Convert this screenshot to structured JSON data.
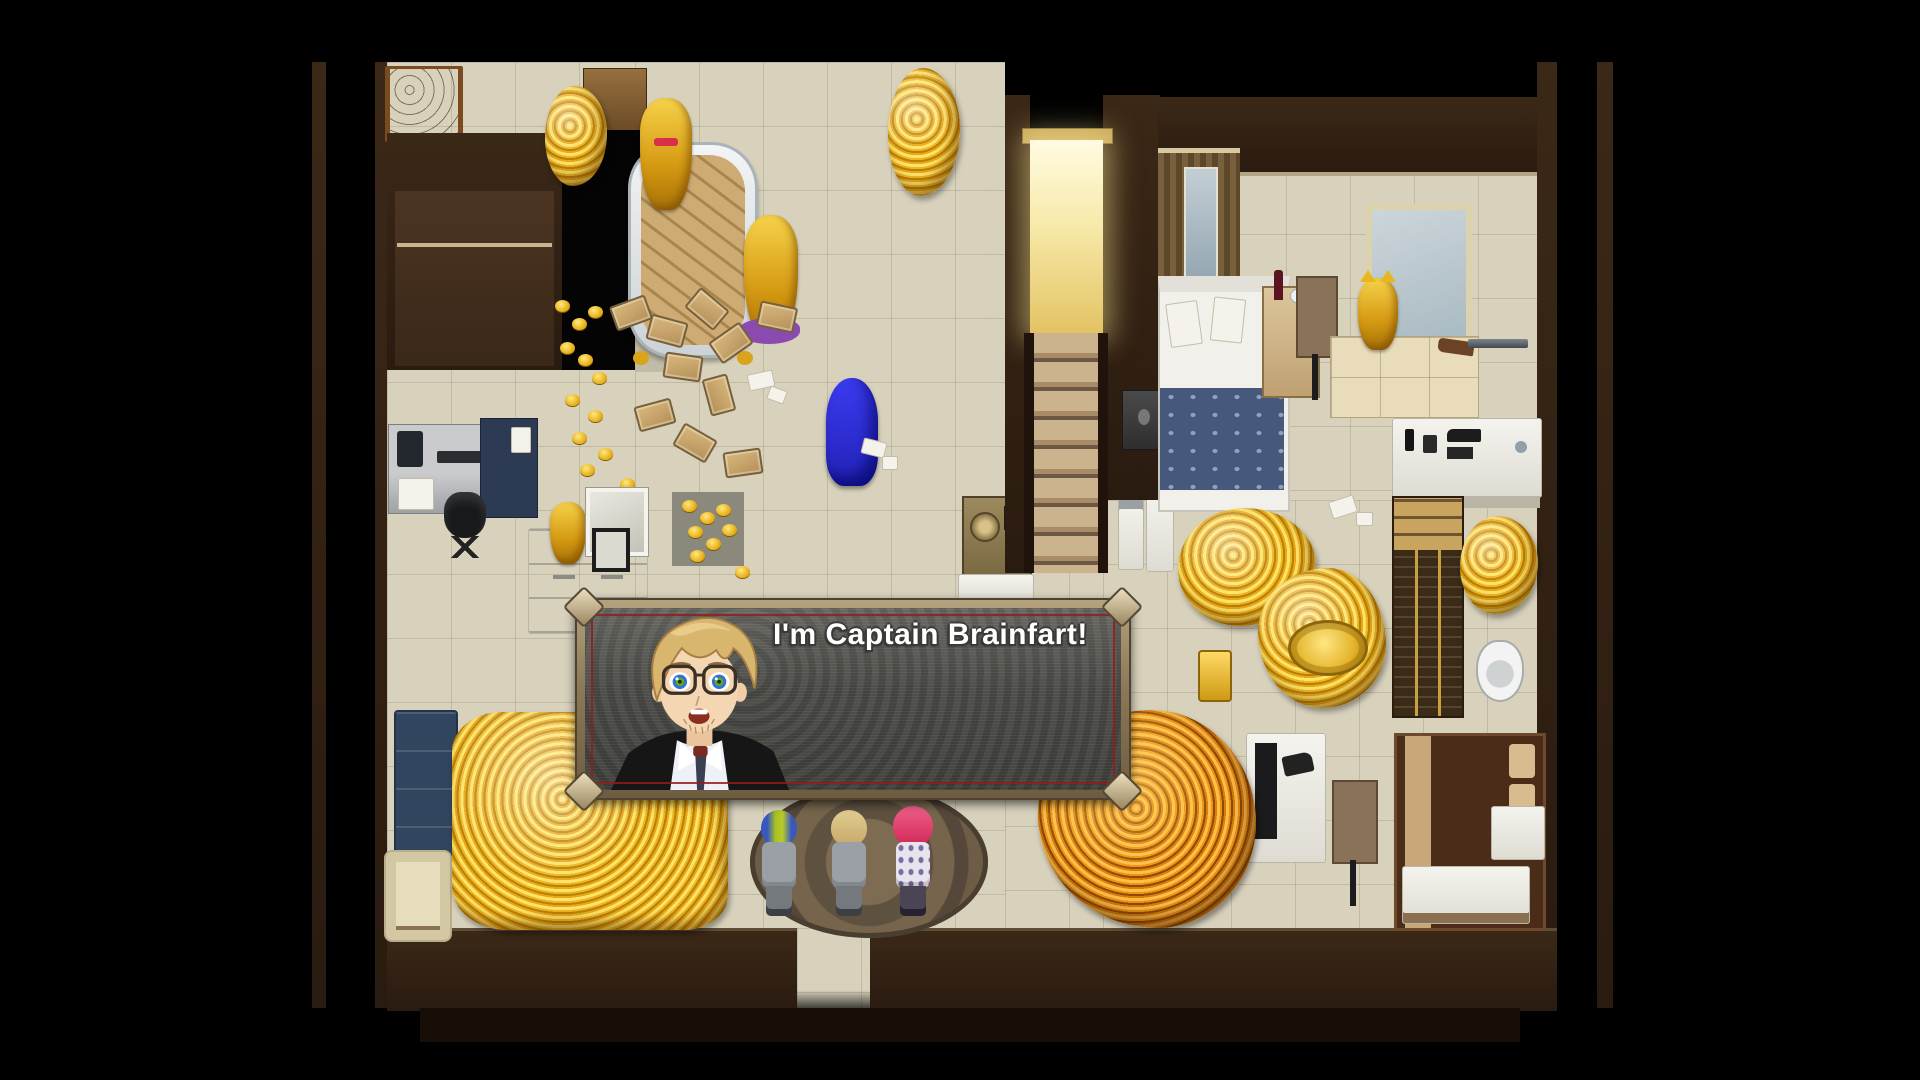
{
  "game": {
    "dialog": {
      "text": "I'm Captain Brainfart!",
      "portrait": "blond-man-with-glasses-in-black-suit"
    },
    "scene": {
      "description_visible_objects": "top-down mansion room filled with gold piles, bathtub of gold bars, golden statues, beds, desks, stairs, glowing doorway, three NPCs on a round rug, blue hooded statue",
      "npc_count": 3
    },
    "colors": {
      "gold": "#e8b020",
      "orange_gold": "#e07808",
      "floor": "#d8d2bd",
      "wall": "#2c1e14",
      "dialog_frame": "#9c8a6a",
      "dialog_inner": "#484844",
      "dialog_inner_border": "#941c1c",
      "doorway_glow": "#f7e9a8",
      "npc_left_hair": "#a8c020",
      "npc_middle_hair": "#d6bd7e",
      "npc_right_hair": "#e84878",
      "blue_statue": "#2830d0"
    }
  }
}
